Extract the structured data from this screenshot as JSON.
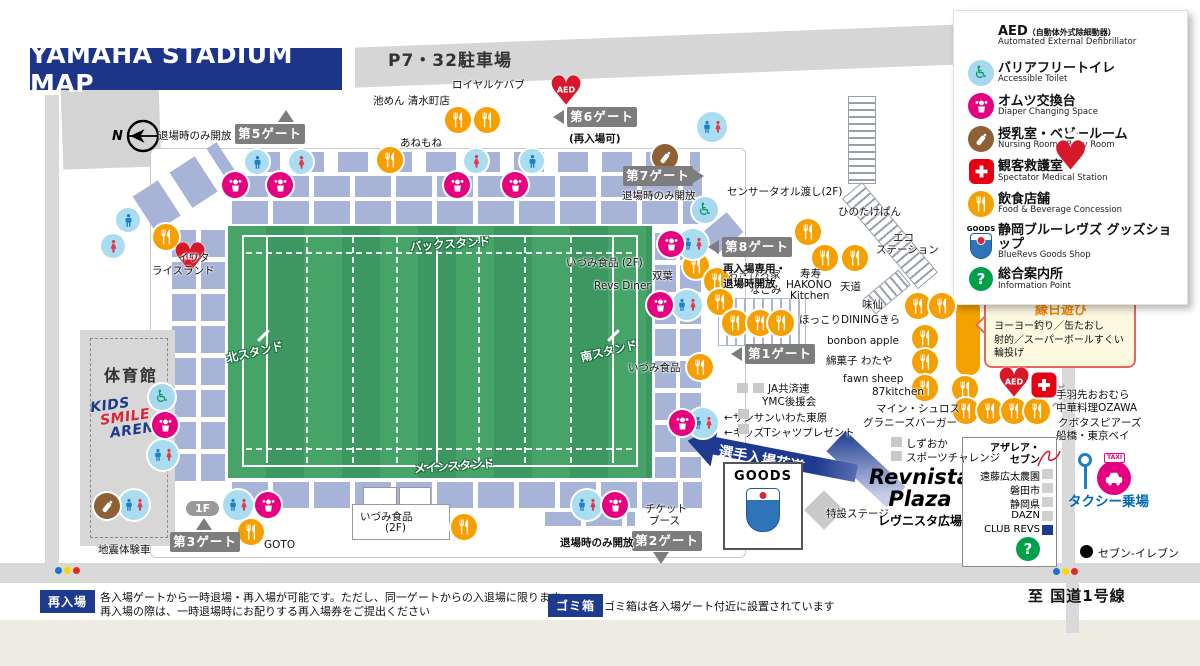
{
  "title": "YAMAHA STADIUM MAP",
  "parking": "P7・32駐車場",
  "compass": "N",
  "stands": {
    "back": "バックスタンド",
    "north": "北スタンド",
    "south": "南スタンド",
    "main": "メインスタンド"
  },
  "gym": "体育館",
  "kids_arena": [
    "KIDS",
    "SMILE",
    "ARENA"
  ],
  "player_walk": "選手入場花道",
  "goods_shop_label": "GOODS",
  "plaza": {
    "line1": "Revnista",
    "line2": "Plaza",
    "jp": "レヴニスタ広場"
  },
  "stage": "特設ステージ",
  "taxi": {
    "label": "タクシー乗場",
    "flag": "TAXI"
  },
  "seven_eleven": "セブン-イレブン",
  "route_label": "至 国道1号線",
  "ennichi": {
    "title": "縁日遊び",
    "lines": [
      "ヨーヨー釣り／缶たおし",
      "射的／スーパーボールすくい",
      "輪投げ"
    ]
  },
  "notes": {
    "reentry_badge": "再入場",
    "reentry_line1": "各入場ゲートから一時退場・再入場が可能です。ただし、同一ゲートからの入退場に限ります",
    "reentry_line2": "再入場の際は、一時退場時にお配りする再入場券をご提出ください",
    "trash_badge": "ゴミ箱",
    "trash_text": "ゴミ箱は各入場ゲート付近に設置されています"
  },
  "legend": {
    "items": [
      {
        "type": "aed",
        "jp": "AED",
        "jp_small": "（自動体外式除細動器）",
        "en": "Automated External Defibrillator"
      },
      {
        "type": "access",
        "jp": "バリアフリートイレ",
        "en": "Accessible Toilet"
      },
      {
        "type": "diaper",
        "jp": "オムツ交換台",
        "en": "Diaper Changing Space"
      },
      {
        "type": "nursing",
        "jp": "授乳室・ベビールーム",
        "en": "Nursing Room・Baby Room"
      },
      {
        "type": "med",
        "jp": "観客救護室",
        "en": "Spectator Medical Station"
      },
      {
        "type": "food",
        "jp": "飲食店舗",
        "en": "Food & Beverage Concession"
      },
      {
        "type": "goods",
        "jp": "静岡ブルーレヴズ グッズショップ",
        "en": "BlueRevs Goods Shop"
      },
      {
        "type": "info",
        "jp": "総合案内所",
        "en": "Information Point"
      }
    ]
  },
  "infobox": {
    "azalea": [
      "アザレア・",
      "セブン"
    ],
    "rows": [
      {
        "t": "遠藤広太農園",
        "navy": false
      },
      {
        "t": "磐田市",
        "navy": false
      },
      {
        "t": "静岡県",
        "navy": false
      },
      {
        "t": "DAZN",
        "navy": false
      },
      {
        "t": "CLUB REVS",
        "navy": true
      }
    ]
  },
  "gates": [
    {
      "name": "第5ゲート",
      "x": 235,
      "y": 124,
      "tri": "u",
      "tx": 278,
      "ty": 110,
      "note": "退場時のみ開放",
      "nx": 158,
      "ny": 128,
      "ns": "plain"
    },
    {
      "name": "第6ゲート",
      "x": 567,
      "y": 107,
      "tri": "l",
      "tx": 553,
      "ty": 110,
      "note": "(再入場可)",
      "nx": 569,
      "ny": 131,
      "ns": "o"
    },
    {
      "name": "第7ゲート",
      "x": 623,
      "y": 166,
      "tri": "r",
      "tx": 693,
      "ty": 169,
      "note": "退場時のみ開放",
      "nx": 622,
      "ny": 188,
      "ns": "plain"
    },
    {
      "name": "第8ゲート",
      "x": 722,
      "y": 237,
      "tri": "l",
      "tx": 708,
      "ty": 240,
      "note": "再入場専用・\n退場時開放",
      "nx": 723,
      "ny": 261,
      "ns": "b"
    },
    {
      "name": "第1ゲート",
      "x": 745,
      "y": 344,
      "tri": "l",
      "tx": 731,
      "ty": 347
    },
    {
      "name": "第2ゲート",
      "x": 632,
      "y": 531,
      "tri": "d",
      "tx": 653,
      "ty": 552,
      "note": "退場時のみ開放",
      "nx": 560,
      "ny": 535,
      "ns": "o"
    },
    {
      "name": "第3ゲート",
      "x": 170,
      "y": 532,
      "tri": "u",
      "tx": 196,
      "ty": 518,
      "note": "1F",
      "nx": 186,
      "ny": 501,
      "ns": "pill"
    }
  ],
  "icons": [
    {
      "t": "food",
      "x": 458,
      "y": 120
    },
    {
      "t": "food",
      "x": 487,
      "y": 120
    },
    {
      "t": "food",
      "x": 390,
      "y": 160
    },
    {
      "t": "food",
      "x": 166,
      "y": 237
    },
    {
      "t": "food",
      "x": 696,
      "y": 266
    },
    {
      "t": "food",
      "x": 717,
      "y": 281
    },
    {
      "t": "food",
      "x": 720,
      "y": 302
    },
    {
      "t": "food",
      "x": 700,
      "y": 367
    },
    {
      "t": "food",
      "x": 735,
      "y": 323
    },
    {
      "t": "food",
      "x": 760,
      "y": 323
    },
    {
      "t": "food",
      "x": 781,
      "y": 323
    },
    {
      "t": "food",
      "x": 808,
      "y": 232
    },
    {
      "t": "food",
      "x": 825,
      "y": 258
    },
    {
      "t": "food",
      "x": 855,
      "y": 258
    },
    {
      "t": "food",
      "x": 918,
      "y": 306
    },
    {
      "t": "food",
      "x": 942,
      "y": 306
    },
    {
      "t": "food",
      "x": 925,
      "y": 338
    },
    {
      "t": "food",
      "x": 925,
      "y": 362
    },
    {
      "t": "food",
      "x": 925,
      "y": 388
    },
    {
      "t": "food",
      "x": 965,
      "y": 389
    },
    {
      "t": "food",
      "x": 966,
      "y": 411
    },
    {
      "t": "food",
      "x": 990,
      "y": 411
    },
    {
      "t": "food",
      "x": 1014,
      "y": 411
    },
    {
      "t": "food",
      "x": 1037,
      "y": 411
    },
    {
      "t": "food",
      "x": 464,
      "y": 527
    },
    {
      "t": "food",
      "x": 251,
      "y": 532
    },
    {
      "t": "toilet-m",
      "x": 128,
      "y": 220
    },
    {
      "t": "toilet-f",
      "x": 113,
      "y": 246
    },
    {
      "t": "toilet-m",
      "x": 257,
      "y": 162
    },
    {
      "t": "toilet-f",
      "x": 301,
      "y": 162
    },
    {
      "t": "toilet-f",
      "x": 476,
      "y": 161
    },
    {
      "t": "toilet-m",
      "x": 532,
      "y": 161
    },
    {
      "t": "toilet-mf",
      "x": 712,
      "y": 127
    },
    {
      "t": "toilet-mf",
      "x": 693,
      "y": 244
    },
    {
      "t": "toilet-mf",
      "x": 687,
      "y": 305
    },
    {
      "t": "toilet-mf",
      "x": 163,
      "y": 455
    },
    {
      "t": "toilet-mf",
      "x": 134,
      "y": 505
    },
    {
      "t": "toilet-mf",
      "x": 238,
      "y": 505
    },
    {
      "t": "toilet-mf",
      "x": 587,
      "y": 505
    },
    {
      "t": "toilet-mf",
      "x": 703,
      "y": 423
    },
    {
      "t": "diaper",
      "x": 235,
      "y": 185
    },
    {
      "t": "diaper",
      "x": 280,
      "y": 185
    },
    {
      "t": "diaper",
      "x": 457,
      "y": 185
    },
    {
      "t": "diaper",
      "x": 515,
      "y": 185
    },
    {
      "t": "diaper",
      "x": 671,
      "y": 244
    },
    {
      "t": "diaper",
      "x": 660,
      "y": 305
    },
    {
      "t": "diaper",
      "x": 165,
      "y": 425
    },
    {
      "t": "diaper",
      "x": 268,
      "y": 505
    },
    {
      "t": "diaper",
      "x": 615,
      "y": 505
    },
    {
      "t": "diaper",
      "x": 682,
      "y": 423
    },
    {
      "t": "nursing",
      "x": 665,
      "y": 157
    },
    {
      "t": "nursing",
      "x": 107,
      "y": 506
    },
    {
      "t": "access",
      "x": 705,
      "y": 210
    },
    {
      "t": "access",
      "x": 162,
      "y": 397
    },
    {
      "t": "aed",
      "x": 566,
      "y": 93
    },
    {
      "t": "aed",
      "x": 190,
      "y": 260
    },
    {
      "t": "aed",
      "x": 1014,
      "y": 385
    },
    {
      "t": "med",
      "x": 1044,
      "y": 385
    },
    {
      "t": "info",
      "x": 1028,
      "y": 549
    }
  ],
  "labels": [
    {
      "t": "ロイヤルケバブ",
      "x": 452,
      "y": 77
    },
    {
      "t": "池めん 清水町店",
      "x": 373,
      "y": 93
    },
    {
      "t": "あねもね",
      "x": 400,
      "y": 135
    },
    {
      "t": "イワタ",
      "x": 178,
      "y": 250
    },
    {
      "t": "ライスランド",
      "x": 152,
      "y": 263
    },
    {
      "t": "センサータオル渡し(2F)",
      "x": 727,
      "y": 184
    },
    {
      "t": "ひのたけぱん",
      "x": 838,
      "y": 204
    },
    {
      "t": "エコ",
      "x": 893,
      "y": 230
    },
    {
      "t": "ステーション",
      "x": 876,
      "y": 242
    },
    {
      "t": "いづみ食品 (2F)",
      "x": 566,
      "y": 255
    },
    {
      "t": "双葉",
      "x": 652,
      "y": 268
    },
    {
      "t": "Revs Diner",
      "x": 594,
      "y": 280
    },
    {
      "t": "おぎひろ家",
      "x": 728,
      "y": 267
    },
    {
      "t": "なごみ",
      "x": 750,
      "y": 282
    },
    {
      "t": "寿寿",
      "x": 800,
      "y": 266
    },
    {
      "t": "HAKONO",
      "x": 786,
      "y": 279
    },
    {
      "t": "Kitchen",
      "x": 790,
      "y": 290
    },
    {
      "t": "天道",
      "x": 840,
      "y": 279
    },
    {
      "t": "味仙",
      "x": 862,
      "y": 297
    },
    {
      "t": "ほっこりDININGきら",
      "x": 799,
      "y": 312
    },
    {
      "t": "bonbon apple",
      "x": 827,
      "y": 335
    },
    {
      "t": "綿菓子 わたや",
      "x": 826,
      "y": 353
    },
    {
      "t": "fawn sheep",
      "x": 843,
      "y": 373
    },
    {
      "t": "87kitchen",
      "x": 872,
      "y": 386
    },
    {
      "t": "マイン・シュロス",
      "x": 876,
      "y": 401
    },
    {
      "t": "グラニーズバーガー",
      "x": 863,
      "y": 415
    },
    {
      "t": "いづみ食品",
      "x": 628,
      "y": 360
    },
    {
      "t": "JA共済連",
      "x": 768,
      "y": 381
    },
    {
      "t": "YMC後援会",
      "x": 762,
      "y": 394
    },
    {
      "t": "←サンサンいわた東原",
      "x": 724,
      "y": 410
    },
    {
      "t": "←キッズTシャツプレゼント",
      "x": 724,
      "y": 425
    },
    {
      "t": "しずおか",
      "x": 906,
      "y": 436
    },
    {
      "t": "スポーツチャレンジ",
      "x": 906,
      "y": 450
    },
    {
      "t": "チケット",
      "x": 645,
      "y": 501
    },
    {
      "t": "ブース",
      "x": 649,
      "y": 513
    },
    {
      "t": "地震体験車",
      "x": 98,
      "y": 542
    },
    {
      "t": "GOTO",
      "x": 264,
      "y": 539
    },
    {
      "t": "いづみ食品",
      "x": 360,
      "y": 509
    },
    {
      "t": "(2F)",
      "x": 385,
      "y": 522
    },
    {
      "t": "手羽先おおむら",
      "x": 1056,
      "y": 387
    },
    {
      "t": "中華料理OZAWA",
      "x": 1056,
      "y": 400
    },
    {
      "t": "クボタスピアーズ",
      "x": 1058,
      "y": 415
    },
    {
      "t": "船橋・東京ベイ",
      "x": 1056,
      "y": 428
    }
  ],
  "squares": [
    {
      "x": 891,
      "y": 437
    },
    {
      "x": 891,
      "y": 451
    },
    {
      "x": 737,
      "y": 383
    },
    {
      "x": 753,
      "y": 383
    },
    {
      "x": 738,
      "y": 409
    },
    {
      "x": 738,
      "y": 424
    }
  ]
}
